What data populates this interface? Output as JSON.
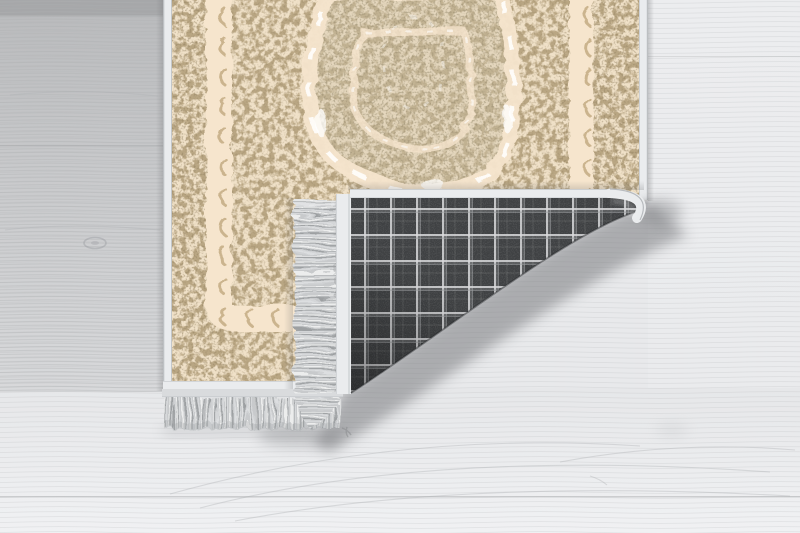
{
  "meta": {
    "type": "product-photo",
    "title": "Cream oriental medallion rug with bottom-right corner folded over, revealing a dark grey plaid woven backing and silver-grey tassel fringe, lying on a whitewashed wood plank floor"
  },
  "scene": {
    "floor": {
      "material": "light whitewashed wood planks",
      "grain_direction": "horizontal",
      "details": [
        "plank seams",
        "small knots",
        "cathedral grain arcs"
      ]
    },
    "rug": {
      "style": "ornate beige medallion carpet",
      "border": "crescent-motif cream stripes inside dense taupe ornament bands",
      "medallion": "scalloped pointed oval with white highlights, partly cut off at top",
      "edges": "white satin binding",
      "fold": "bottom-right corner folded over on a diagonal crease",
      "backing": "dark charcoal tartan plaid weave",
      "fringe": "silver-grey tassel fringe on short ends"
    }
  },
  "colors": {
    "floor-base": "#e8e9eb",
    "floor-top-band": "#a6a7a9",
    "floor-seam": "#aaabad",
    "grain": "#aeb0b2",
    "rug-cream": "#f0e1c8",
    "ornament": "#b09c77",
    "ornament-dark": "#8c7b5b",
    "stripe-cream": "#f6e5cd",
    "crescent": "#c3ac83",
    "medallion-tint": "#cfc5ac",
    "binding": "#eaecee",
    "binding-line": "#b9bec1",
    "plaid-base": "#3f4143",
    "plaid-line": "#d8d9db",
    "plaid-line2": "#9fa1a3",
    "fringe-base": "#c8cacc",
    "fringe-light": "#eceded",
    "fringe-dark": "#9da0a2",
    "shadow": "#6f7174",
    "white": "#ffffff"
  }
}
